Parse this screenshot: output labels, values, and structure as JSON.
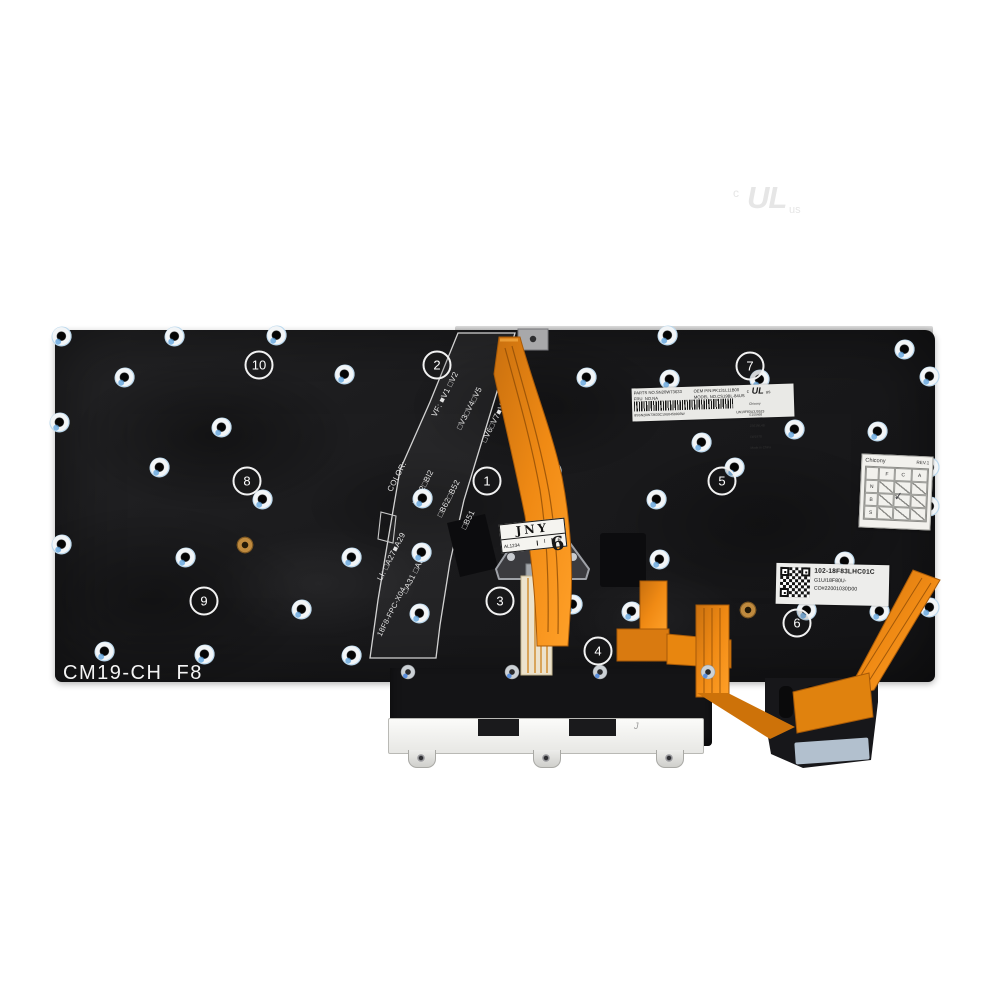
{
  "watermark": {
    "c": "c",
    "ul": "UL",
    "us": "us"
  },
  "silkscreen": {
    "model_text": "CM19-CH  F8",
    "vf_lines": [
      "VF: ■V1 □V2",
      "□V3□V4□V5",
      "□V6□V7■V8"
    ],
    "color_lines": [
      "COLOR:",
      "□Bk2□Bl2",
      "□B62□B52",
      "□B51"
    ],
    "li_lines": [
      "LI: □A27■A29",
      "□A31 □A33"
    ],
    "fpc_text": "18F8-FPC-X04"
  },
  "callouts": [
    "1",
    "2",
    "3",
    "4",
    "5",
    "6",
    "7",
    "8",
    "9",
    "10"
  ],
  "barcode_label": {
    "parts_no": "PARTS NO.SN20W73633",
    "fru_no": "FRU  NO.NA",
    "oem_pn": "OEM P/N:PK131L11B00",
    "model_no": "MODEL NO.CS19BL-84US",
    "cert_c": "c",
    "cert_ul": "UL",
    "cert_us": "us",
    "maker_lines": [
      "Chicony",
      "E150468",
      "JS61NL4B",
      "LW1978"
    ],
    "made_in": "Made in China",
    "barcode_text": "8SSN20W73633C19U0450003W",
    "right_code": "LW19F83U3J0523"
  },
  "qr_label": {
    "line1": "102-18F83LHC01C",
    "line2": "G1U/18F80U-",
    "line3": "CO#22001030D00"
  },
  "rev_table": {
    "maker": "Chicony",
    "rev": "REV.1",
    "cols": [
      "F",
      "C",
      "A"
    ],
    "rows": [
      "N",
      "B",
      "S"
    ],
    "check": "✓"
  },
  "jny_label": {
    "title": "JNY",
    "cell1": "AL1234",
    "cell2": "I",
    "cell3": "6",
    "hand_mark": "6"
  },
  "strip_mark": "J"
}
